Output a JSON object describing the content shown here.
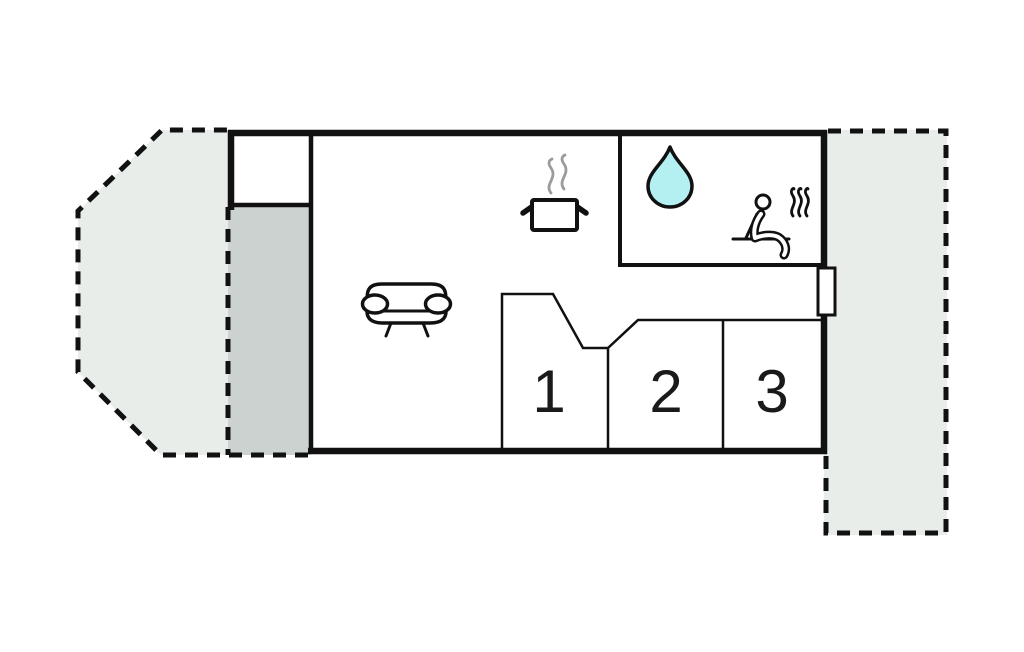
{
  "colors": {
    "background": "#ffffff",
    "wall": "#111111",
    "icon_ink": "#111111",
    "terrace_fill": "#e8edea",
    "porch_fill": "#ccd2d0",
    "water_drop_fill": "#b4f0f2",
    "steam": "#9b9b9b",
    "label_ink": "#1a1a1a"
  },
  "bedrooms": {
    "labels": [
      "1",
      "2",
      "3"
    ]
  },
  "icons": {
    "kitchen": "cooking-pot-icon",
    "bathroom": "water-drop-icon",
    "sauna": "sauna-person-icon",
    "living_room": "sofa-icon"
  }
}
